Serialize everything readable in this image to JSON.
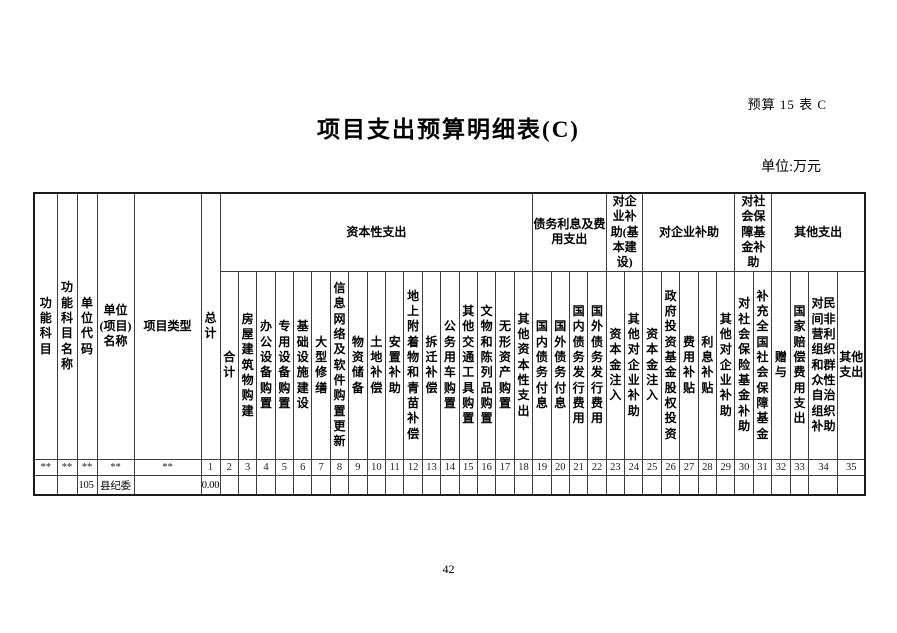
{
  "page": {
    "corner_label": "预算 15 表 C",
    "title": "项目支出预算明细表(C)",
    "unit_label": "单位:万元",
    "page_number": "42"
  },
  "table": {
    "left_headers": [
      "功能科目",
      "功能科目名称",
      "单位代码",
      "单位\n(项目)\n名称",
      "项目类型",
      "总计"
    ],
    "groups": [
      {
        "label": "资本性支出",
        "span": 17
      },
      {
        "label": "债务利息及费用支出",
        "span": 4
      },
      {
        "label": "对企业补助(基本建设)",
        "span": 2
      },
      {
        "label": "对企业补助",
        "span": 5
      },
      {
        "label": "对社会保障基金补助",
        "span": 2
      },
      {
        "label": "其他支出",
        "span": 4
      }
    ],
    "columns": [
      "合计",
      "房屋建筑物购建",
      "办公设备购置",
      "专用设备购置",
      "基础设施建设",
      "大型修缮",
      "信息网络及软件购置更新",
      "物资储备",
      "土地补偿",
      "安置补助",
      "地上附着物和青苗补偿",
      "拆迁补偿",
      "公务用车购置",
      "其他交通工具购置",
      "文物和陈列品购置",
      "无形资产购置",
      "其他资本性支出",
      "国内债务付息",
      "国外债务付息",
      "国内债务发行费用",
      "国外债务发行费用",
      "资本金注入",
      "其他对企业补助",
      "资本金注入",
      "政府投资基金股权投资",
      "费用补贴",
      "利息补贴",
      "其他对企业补助",
      "对社会保险基金补助",
      "补充全国社会保障基金",
      "赠与",
      "国家赔偿费用支出",
      "对民间非营利组织和群众性自治组织补助",
      "其他支出"
    ],
    "col_numbers": [
      "**",
      "**",
      "**",
      "**",
      "**",
      "1",
      "2",
      "3",
      "4",
      "5",
      "6",
      "7",
      "8",
      "9",
      "10",
      "11",
      "12",
      "13",
      "14",
      "15",
      "16",
      "17",
      "18",
      "19",
      "20",
      "21",
      "22",
      "23",
      "24",
      "25",
      "26",
      "27",
      "28",
      "29",
      "30",
      "31",
      "32",
      "33",
      "34",
      "35"
    ],
    "data_row": [
      "",
      "",
      "105",
      "县纪委",
      "",
      "0.00",
      "",
      "",
      "",
      "",
      "",
      "",
      "",
      "",
      "",
      "",
      "",
      "",
      "",
      "",
      "",
      "",
      "",
      "",
      "",
      "",
      "",
      "",
      "",
      "",
      "",
      "",
      "",
      "",
      "",
      "",
      "",
      "",
      "",
      ""
    ]
  }
}
